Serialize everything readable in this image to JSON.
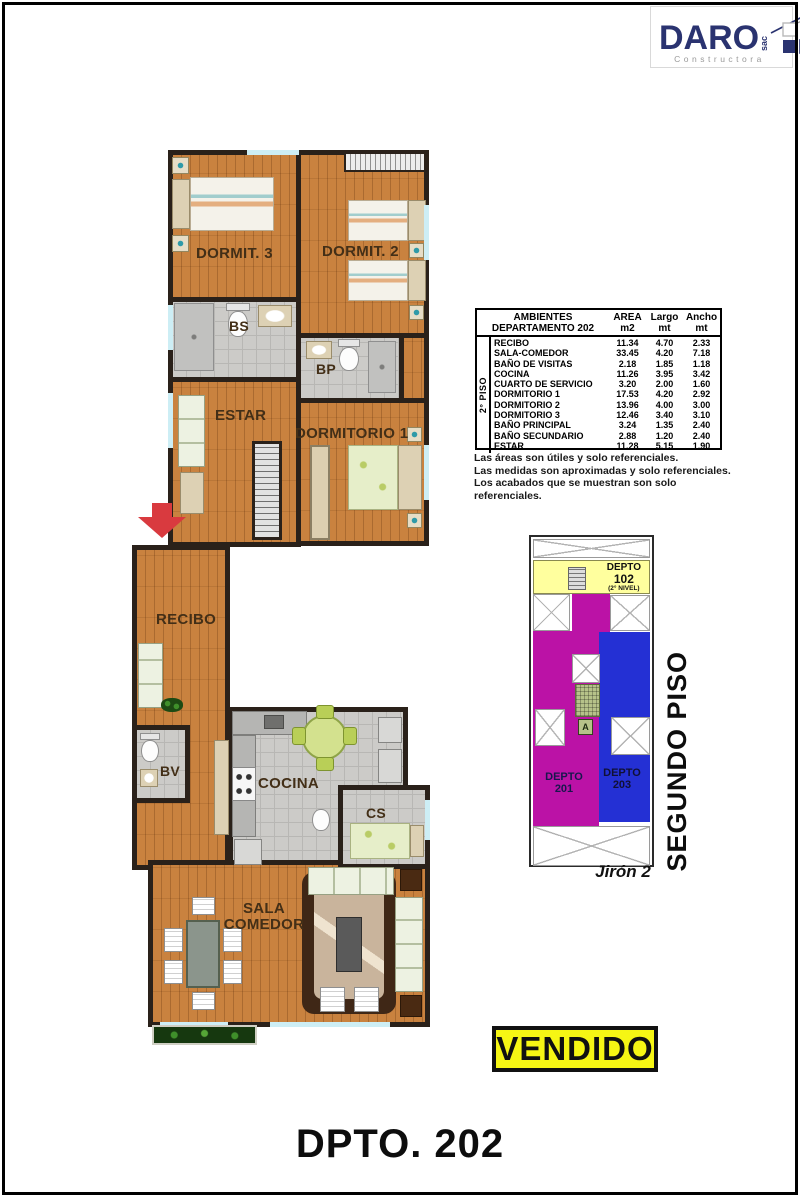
{
  "logo": {
    "word": "DARO",
    "sub": "sac",
    "tagline": "Constructora"
  },
  "plan": {
    "rooms": {
      "dorm3": "DORMIT. 3",
      "dorm2": "DORMIT. 2",
      "bs": "BS",
      "bp": "BP",
      "estar": "ESTAR",
      "dorm1": "DORMITORIO 1",
      "recibo": "RECIBO",
      "bv": "BV",
      "cocina": "COCINA",
      "cs": "CS",
      "sala": "SALA COMEDOR"
    }
  },
  "table": {
    "title1": "AMBIENTES",
    "title2": "DEPARTAMENTO 202",
    "columns": [
      {
        "l1": "AREA",
        "l2": "m2"
      },
      {
        "l1": "Largo",
        "l2": "mt"
      },
      {
        "l1": "Ancho",
        "l2": "mt"
      }
    ],
    "floor_label": "2° PISO",
    "rows": [
      [
        "RECIBO",
        "11.34",
        "4.70",
        "2.33"
      ],
      [
        "SALA-COMEDOR",
        "33.45",
        "4.20",
        "7.18"
      ],
      [
        "BAÑO DE VISITAS",
        "2.18",
        "1.85",
        "1.18"
      ],
      [
        "COCINA",
        "11.26",
        "3.95",
        "3.42"
      ],
      [
        "CUARTO DE SERVICIO",
        "3.20",
        "2.00",
        "1.60"
      ],
      [
        "DORMITORIO 1",
        "17.53",
        "4.20",
        "2.92"
      ],
      [
        "DORMITORIO 2",
        "13.96",
        "4.00",
        "3.00"
      ],
      [
        "DORMITORIO 3",
        "12.46",
        "3.40",
        "3.10"
      ],
      [
        "BAÑO PRINCIPAL",
        "3.24",
        "1.35",
        "2.40"
      ],
      [
        "BAÑO SECUNDARIO",
        "2.88",
        "1.20",
        "2.40"
      ],
      [
        "ESTAR",
        "11.28",
        "5.15",
        "1.90"
      ]
    ]
  },
  "notes": [
    "Las áreas son útiles y solo referenciales.",
    "Las medidas son aproximadas y solo referenciales.",
    "Los acabados que se muestran son solo referenciales."
  ],
  "diagram": {
    "unit102": {
      "line1": "DEPTO",
      "line2": "102",
      "line3": "(2° NIVEL)"
    },
    "unit201": {
      "line1": "DEPTO",
      "line2": "201"
    },
    "unit203": {
      "line1": "DEPTO",
      "line2": "203"
    },
    "stair_label": "A",
    "floor_text": "SEGUNDO PISO",
    "street": "Jirón 2",
    "colors": {
      "unit201": "#bb12a6",
      "unit203": "#2430d4",
      "unit102": "#ffff9e",
      "stairs": "#b6c289"
    }
  },
  "badge": {
    "label": "VENDIDO",
    "bg": "#f6f614"
  },
  "footer": {
    "title": "DPTO. 202"
  }
}
